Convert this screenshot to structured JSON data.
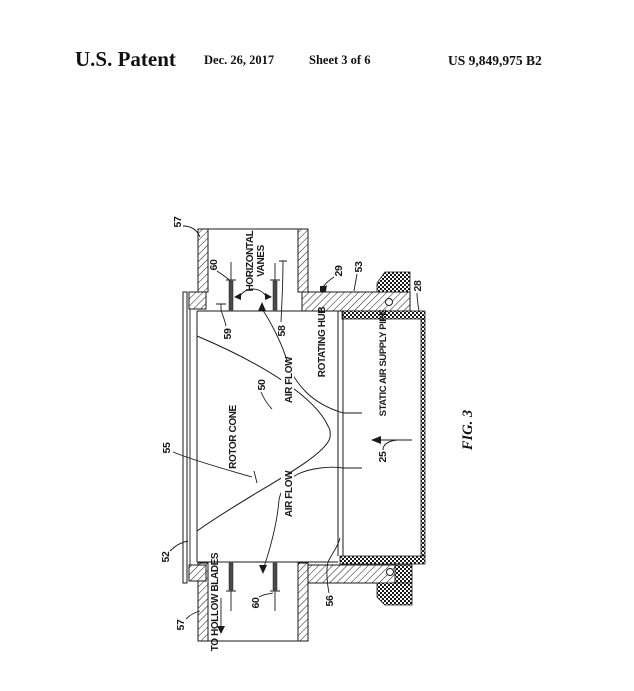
{
  "header": {
    "title": "U.S. Patent",
    "date": "Dec. 26, 2017",
    "sheet": "Sheet 3 of 6",
    "patent_number": "US 9,849,975 B2"
  },
  "figure": {
    "caption": "FIG. 3",
    "labels": {
      "ref_57_top": "57",
      "ref_60_top": "60",
      "horizontal": "HORIZONTAL",
      "vanes": "VANES",
      "ref_59": "59",
      "ref_58": "58",
      "ref_29": "29",
      "ref_53": "53",
      "ref_28": "28",
      "rotating_hub": "ROTATING HUB",
      "static_air_supply_pipe": "STATIC AIR SUPPLY PIPE",
      "ref_50": "50",
      "air_flow_top": "AIR FLOW",
      "rotor_cone": "ROTOR CONE",
      "ref_55": "55",
      "air_flow_bottom": "AIR FLOW",
      "ref_52": "52",
      "ref_57_bottom": "57",
      "ref_60_bottom": "60",
      "ref_56": "56",
      "ref_25": "25",
      "to_hollow_blades": "TO HOLLOW BLADES"
    }
  },
  "colors": {
    "ink": "#1a1a1a",
    "paper": "#ffffff",
    "vane_fill": "#4a4a4a"
  }
}
